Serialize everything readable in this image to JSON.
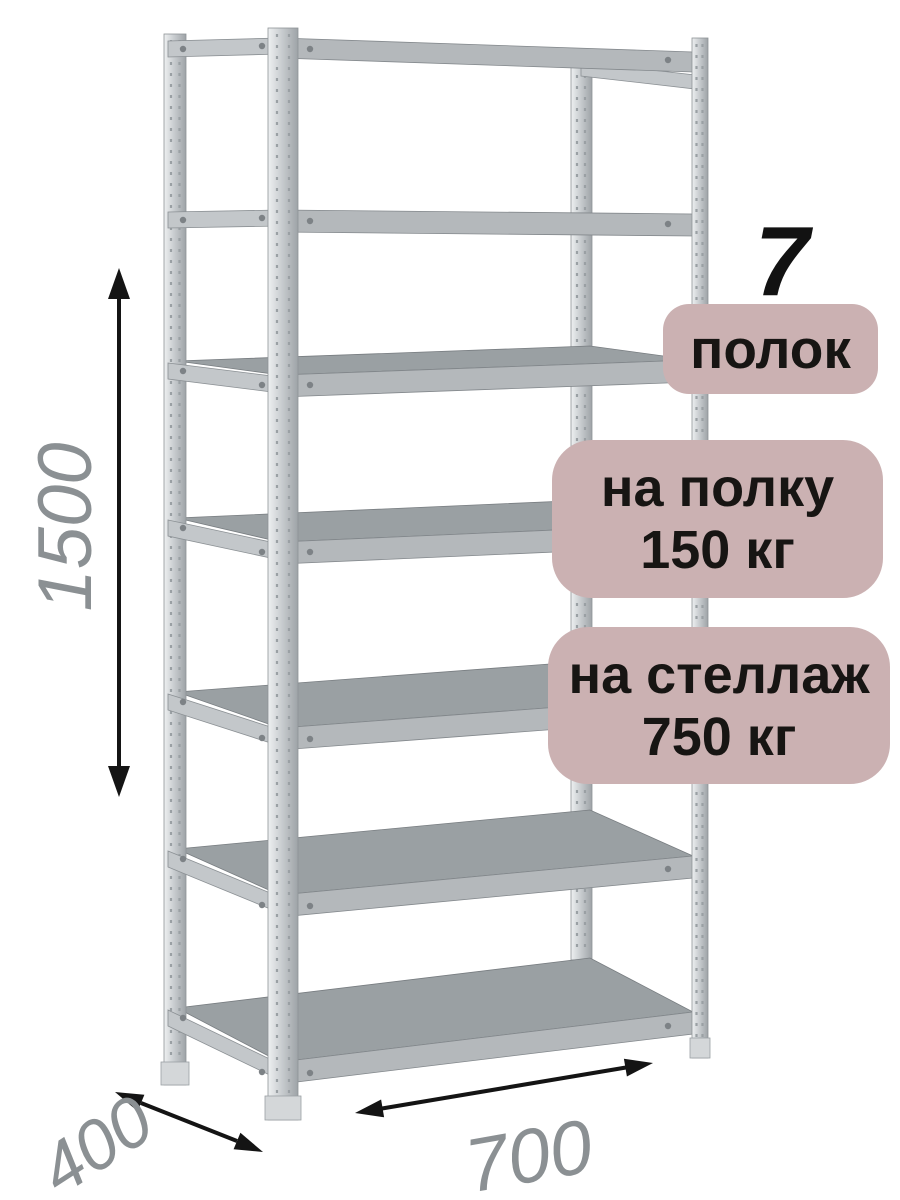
{
  "callouts": {
    "shelf_count": {
      "number": "7",
      "label": "полок"
    },
    "shelf_load": {
      "line1": "на полку",
      "line2": "150 кг"
    },
    "rack_load": {
      "line1": "на стеллаж",
      "line2": "750 кг"
    }
  },
  "dimensions": {
    "height_mm": "1500",
    "depth_mm": "400",
    "width_mm": "700"
  },
  "colors": {
    "badge_background": "#cbb1b2",
    "badge_text": "#171513",
    "dimension_text": "#8b9093",
    "arrow": "#141414",
    "metal_mid": "#b4b8bb",
    "metal_dark": "#9aa0a3"
  }
}
